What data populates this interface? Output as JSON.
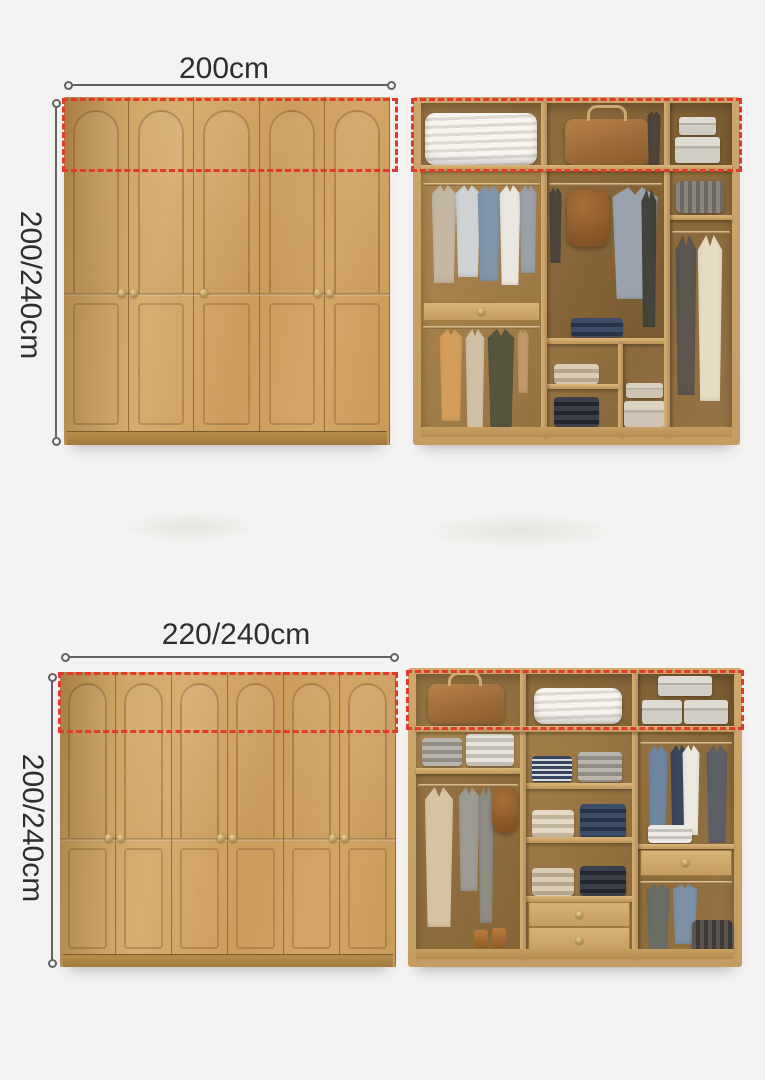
{
  "sections": [
    {
      "id": "variant-200",
      "width_label": "200cm",
      "height_label": "200/240cm",
      "door_count": 5
    },
    {
      "id": "variant-220",
      "width_label": "220/240cm",
      "height_label": "200/240cm",
      "door_count": 6
    }
  ],
  "colors": {
    "background": "#f4f3f1",
    "label_text": "#2e2e2e",
    "dimension_line": "#636363",
    "highlight_red": "#e03a2c",
    "wood_light": "#d7ac70",
    "wood_mid": "#cb9c5c",
    "wood_frame": "#c9a267",
    "interior_shadow": "#8b6a3b"
  }
}
